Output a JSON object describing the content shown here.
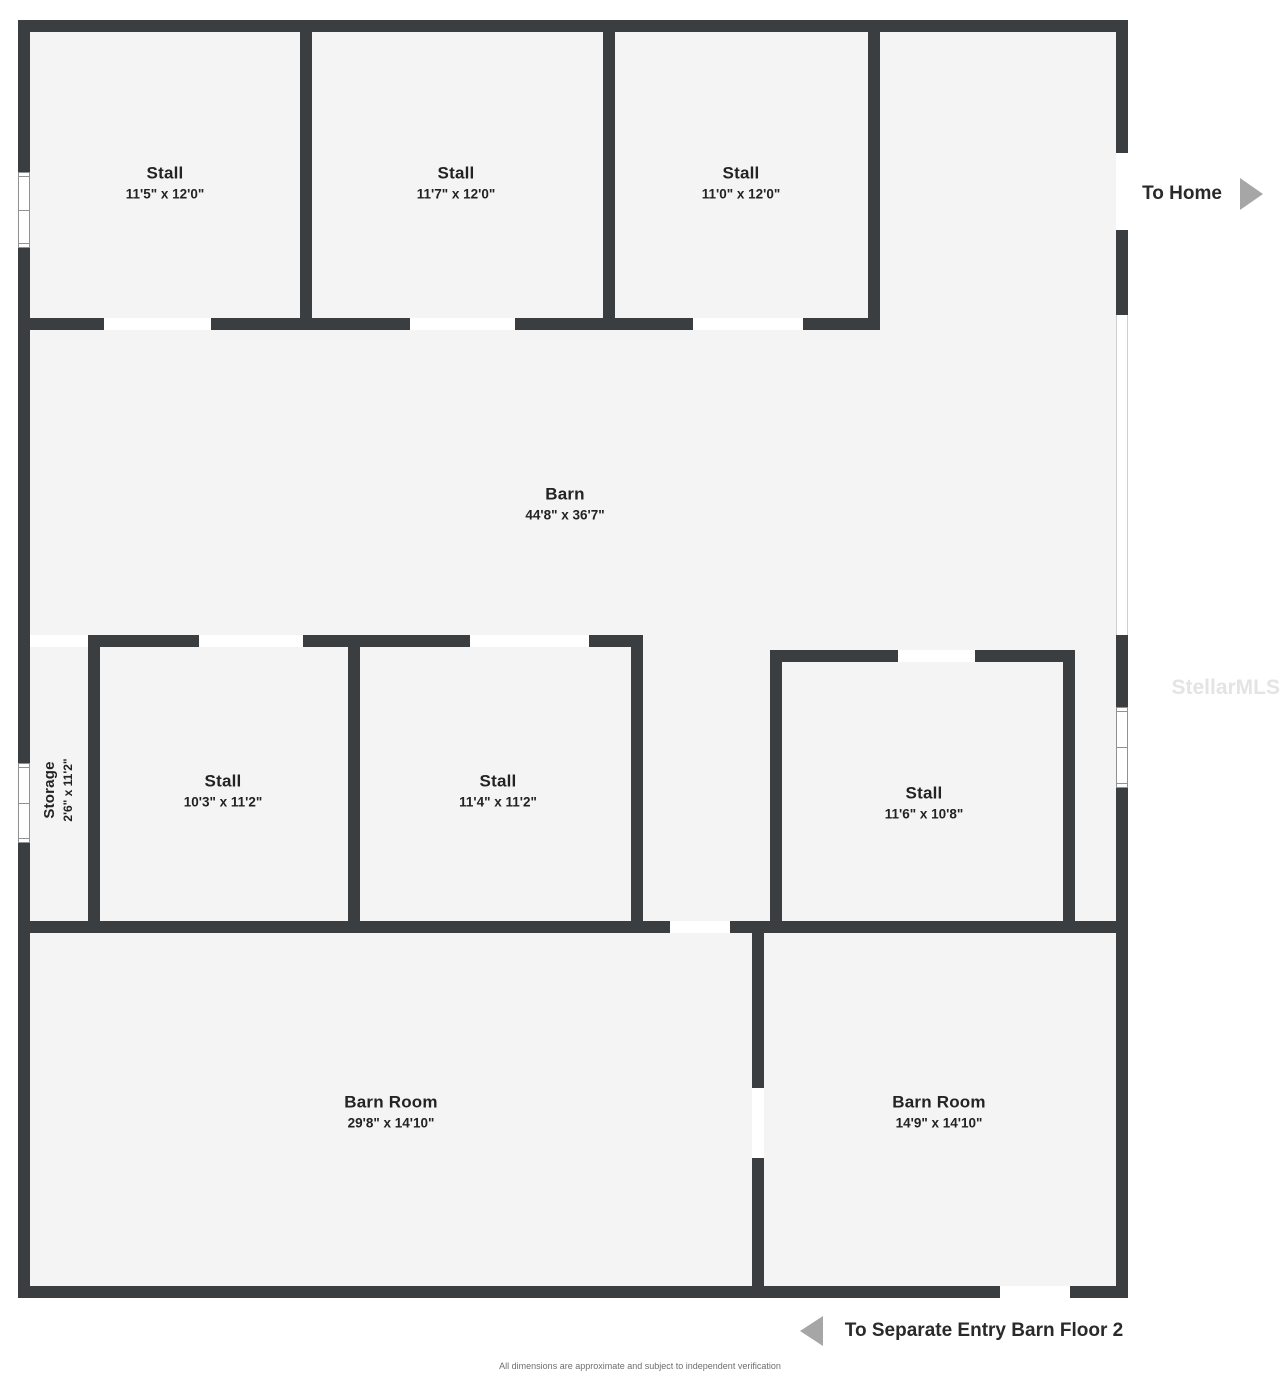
{
  "colors": {
    "wall": "#3b3e40",
    "floor": "#f4f4f4",
    "label": "#232323",
    "arrow": "#a6a6a6",
    "muted": "#6e6e6e",
    "watermark": "#e4e4e4",
    "windowframe": "#8f9193",
    "openedge": "#cfcfcf"
  },
  "rooms": [
    {
      "name": "Stall",
      "dims": "11'5\" x 12'0\""
    },
    {
      "name": "Stall",
      "dims": "11'7\" x 12'0\""
    },
    {
      "name": "Stall",
      "dims": "11'0\" x 12'0\""
    },
    {
      "name": "Barn",
      "dims": "44'8\" x 36'7\""
    },
    {
      "name": "Storage",
      "dims": "2'6\" x 11'2\""
    },
    {
      "name": "Stall",
      "dims": "10'3\" x 11'2\""
    },
    {
      "name": "Stall",
      "dims": "11'4\" x 11'2\""
    },
    {
      "name": "Stall",
      "dims": "11'6\" x 10'8\""
    },
    {
      "name": "Barn Room",
      "dims": "29'8\" x 14'10\""
    },
    {
      "name": "Barn Room",
      "dims": "14'9\" x 14'10\""
    }
  ],
  "exits": [
    {
      "label": "To Home"
    },
    {
      "label": "To Separate Entry Barn Floor 2"
    }
  ],
  "watermark": "StellarMLS",
  "disclaimer": "All dimensions are approximate and subject to independent verification"
}
